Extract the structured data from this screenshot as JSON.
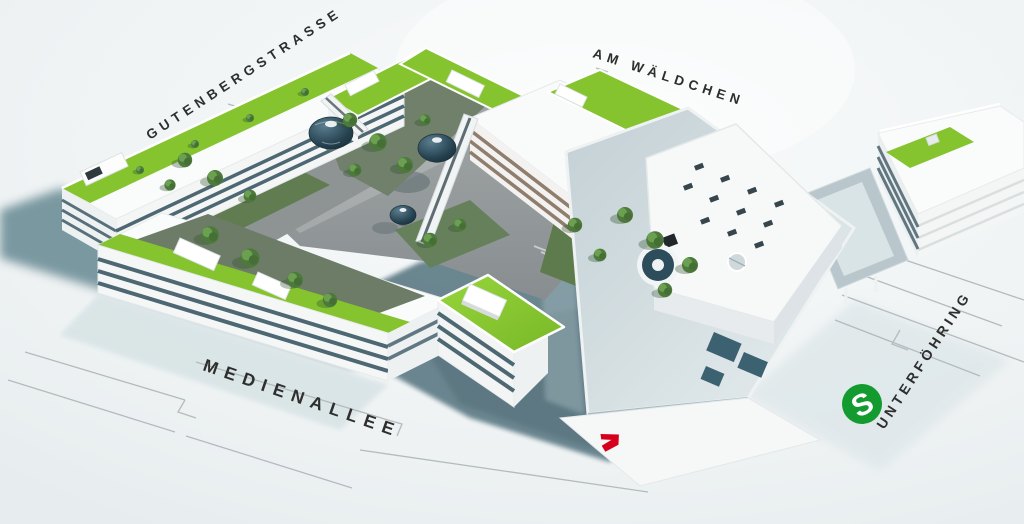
{
  "scene": {
    "type": "aerial architectural site rendering",
    "labels": {
      "street_top_left": "GUTENBERGSTRASSE",
      "street_top_right": "AM WÄLDCHEN",
      "street_bottom": "MEDIENALLEE",
      "street_right": "UNTERFÖHRING",
      "sbahn_letter": "S"
    },
    "logos": {
      "sbahn": "s-bahn-station-logo",
      "broadcaster": "red-seven-logo"
    },
    "colors": {
      "background": "#eff2f3",
      "shadow_teal": "#5d828c",
      "ground_shadow": "#64808a",
      "pale_shadow": "#d6e2e4",
      "building_white": "#fafbfb",
      "facade_glass": "#32505d",
      "facade_warm": "#85725f",
      "roof_green": "#85c42f",
      "roof_green_light": "#a8d94e",
      "tree_green": "#4d7a3c",
      "plaza_gray": "#95999b",
      "dome_teal": "#2e4d5c",
      "glass_roof": "#ccd8dc",
      "label_text": "#2e2e2e",
      "sbahn_green": "#149b30",
      "logo_red": "#d6001c",
      "street_line": "#b4bbbe"
    }
  }
}
